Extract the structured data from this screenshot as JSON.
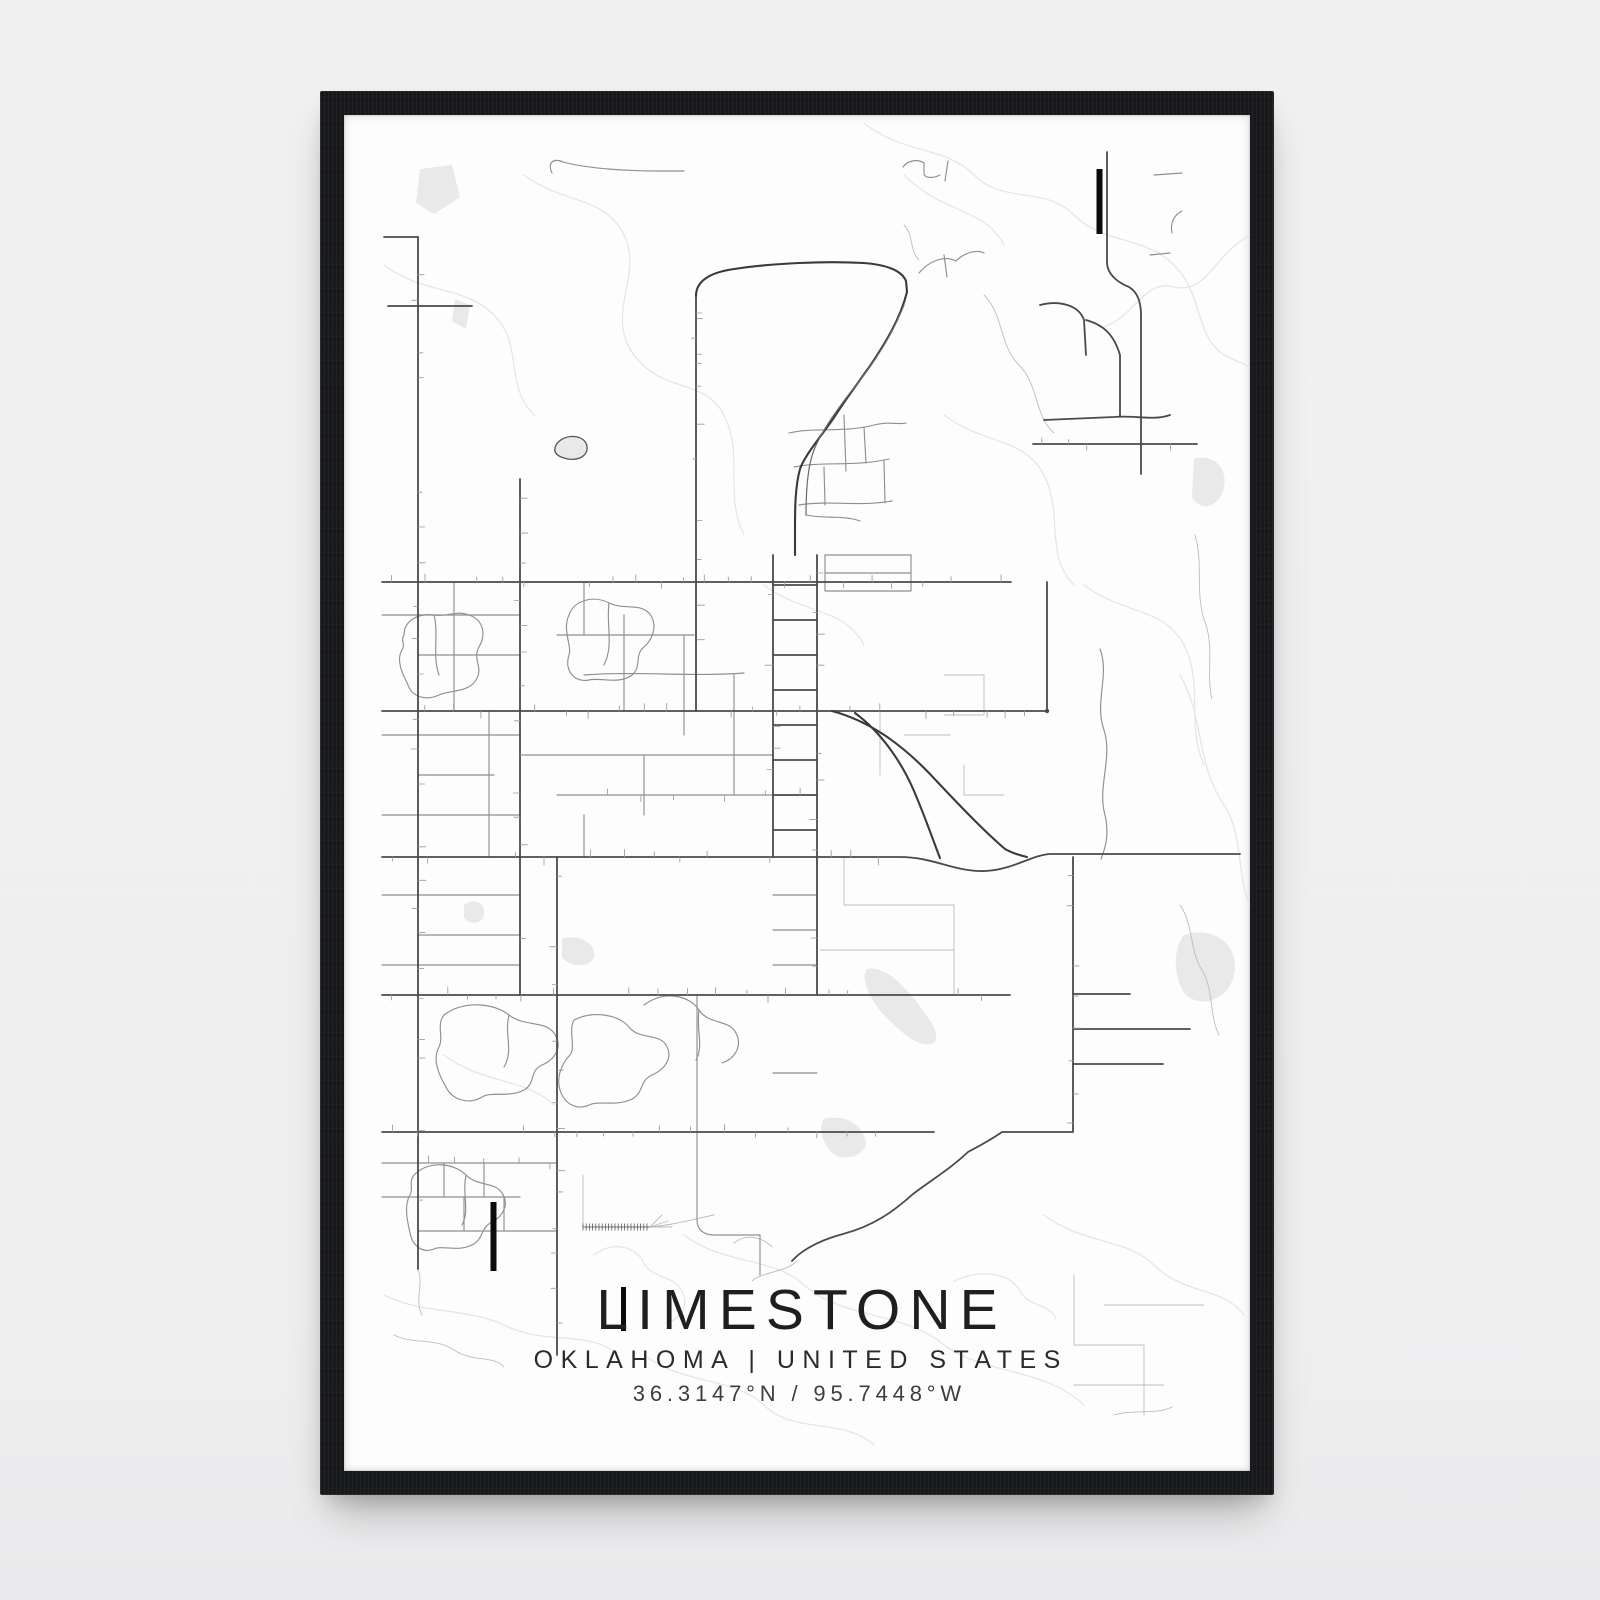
{
  "poster": {
    "title": "LIMESTONE",
    "subtitle": "OKLAHOMA | UNITED STATES",
    "coordinates": "36.3147°N / 95.7448°W"
  },
  "colors": {
    "background": "#f0f0f1",
    "frame": "#17181a",
    "paper": "#fdfdfe",
    "title_text": "#1f1f1f",
    "subtitle_text": "#2b2b2b",
    "coords_text": "#3d3d3d",
    "road_major": "#4a4a4a",
    "road_mid": "#8f8f8f",
    "road_minor": "#bdbdbd",
    "contour": "#e6e6e6",
    "water": "#e9e9e9",
    "runway": "#0b0b0b"
  }
}
